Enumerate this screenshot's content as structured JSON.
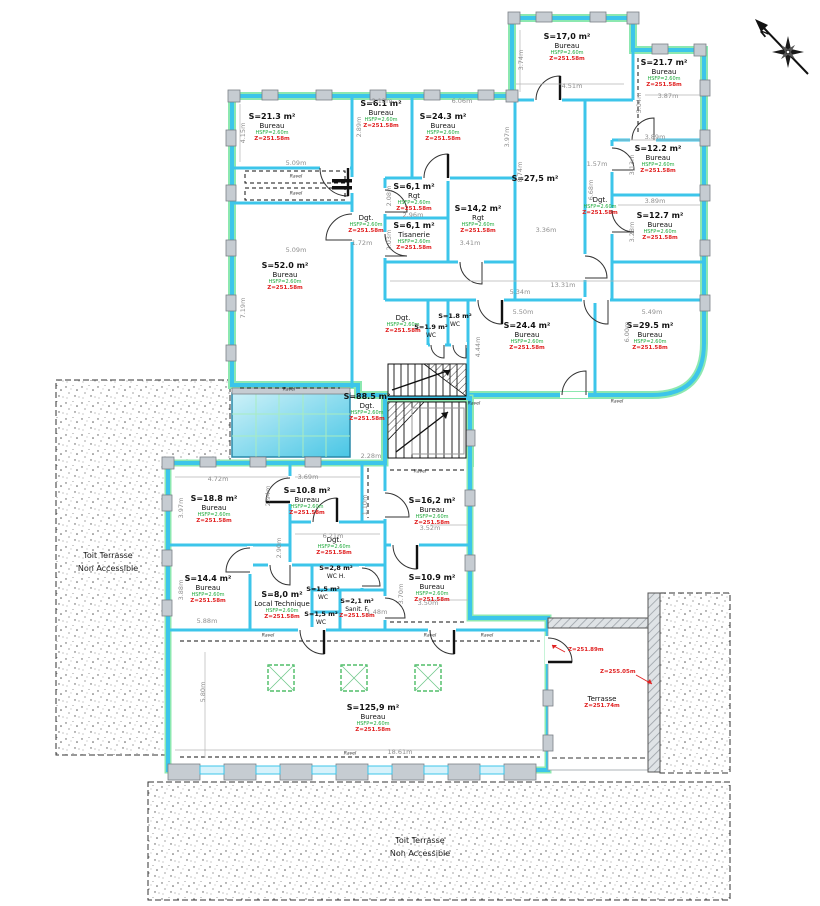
{
  "compass": {
    "label": "N"
  },
  "colors": {
    "wall_cyan": "#3cc5ea",
    "facade_green": "#8ce8b0",
    "label_green": "#1faa3c",
    "label_red": "#e02020",
    "dim_gray": "#8f8f8f",
    "canopy_cyan": "#49c6e5"
  },
  "rooms": [
    {
      "area": "S=21.3 m²",
      "name": "Bureau",
      "hsfp": "HSFP=2.60m",
      "z": "Z=251.58m",
      "x": 272,
      "y": 112
    },
    {
      "area": "S=6.1 m²",
      "name": "Bureau",
      "hsfp": "HSFP=2.60m",
      "z": "Z=251.58m",
      "x": 381,
      "y": 99
    },
    {
      "area": "S=24.3 m²",
      "name": "Bureau",
      "hsfp": "HSFP=2.60m",
      "z": "Z=251.58m",
      "x": 443,
      "y": 112
    },
    {
      "area": "S=17,0 m²",
      "name": "Bureau",
      "hsfp": "HSFP=2.60m",
      "z": "Z=251.58m",
      "x": 567,
      "y": 32
    },
    {
      "area": "S=21.7 m²",
      "name": "Bureau",
      "hsfp": "HSFP=2.60m",
      "z": "Z=251.58m",
      "x": 664,
      "y": 58
    },
    {
      "area": "S=27,5 m²",
      "x": 535,
      "y": 174
    },
    {
      "area": "S=12.2 m²",
      "name": "Bureau",
      "hsfp": "HSFP=2.60m",
      "z": "Z=251.58m",
      "x": 658,
      "y": 144
    },
    {
      "area": "S=12.7 m²",
      "name": "Bureau",
      "hsfp": "HSFP=2.60m",
      "z": "Z=251.58m",
      "x": 660,
      "y": 211
    },
    {
      "area": "S=6,1 m²",
      "name": "Rgt",
      "hsfp": "HSFP=2.60m",
      "z": "Z=251.58m",
      "x": 414,
      "y": 182
    },
    {
      "area": "S=14,2 m²",
      "name": "Rgt",
      "hsfp": "HSFP=2.60m",
      "z": "Z=251.58m",
      "x": 478,
      "y": 204
    },
    {
      "area": "S=6,1 m²",
      "name": "Tisanerie",
      "hsfp": "HSFP=2.60m",
      "z": "Z=251.58m",
      "x": 414,
      "y": 221
    },
    {
      "area": "S=52.0 m²",
      "name": "Bureau",
      "hsfp": "HSFP=2.60m",
      "z": "Z=251.58m",
      "x": 285,
      "y": 261
    },
    {
      "name": "Dgt.",
      "hsfp": "HSFP=2.60m",
      "z": "Z=251.58m",
      "x": 366,
      "y": 214
    },
    {
      "name": "Dgt.",
      "hsfp": "HSFP=2.60m",
      "z": "Z=251.58m",
      "x": 600,
      "y": 196
    },
    {
      "name": "Dgt.",
      "hsfp": "HSFP=2.60m",
      "z": "Z=251.58m",
      "x": 403,
      "y": 314
    },
    {
      "area": "S=1.8 m²",
      "name": "WC",
      "small": true,
      "x": 455,
      "y": 313
    },
    {
      "area": "S=1.9 m²",
      "name": "WC",
      "small": true,
      "x": 431,
      "y": 324
    },
    {
      "area": "S=24.4 m²",
      "name": "Bureau",
      "hsfp": "HSFP=2.60m",
      "z": "Z=251.58m",
      "x": 527,
      "y": 321
    },
    {
      "area": "S=29.5 m²",
      "name": "Bureau",
      "hsfp": "HSFP=2.60m",
      "z": "Z=251.58m",
      "x": 650,
      "y": 321
    },
    {
      "area": "S=88.5 m²",
      "name": "Dgt.",
      "hsfp": "HSFP=2.60m",
      "z": "Z=251.58m",
      "x": 367,
      "y": 392
    },
    {
      "area": "S=18.8 m²",
      "name": "Bureau",
      "hsfp": "HSFP=2.60m",
      "z": "Z=251.58m",
      "x": 214,
      "y": 494
    },
    {
      "area": "S=10.8 m²",
      "name": "Bureau",
      "hsfp": "HSFP=2.60m",
      "z": "Z=251.58m",
      "x": 307,
      "y": 486
    },
    {
      "area": "S=16,2 m²",
      "name": "Bureau",
      "hsfp": "HSFP=2.60m",
      "z": "Z=251.58m",
      "x": 432,
      "y": 496
    },
    {
      "area": "S=14.4 m²",
      "name": "Bureau",
      "hsfp": "HSFP=2.60m",
      "z": "Z=251.58m",
      "x": 208,
      "y": 574
    },
    {
      "area": "S=8,0 m²",
      "name": "Local Technique",
      "hsfp": "HSFP=2.60m",
      "z": "Z=251.58m",
      "x": 282,
      "y": 590
    },
    {
      "area": "S=2,8 m²",
      "name": "WC H.",
      "small": true,
      "x": 336,
      "y": 565
    },
    {
      "area": "S=1,5 m²",
      "name": "WC",
      "small": true,
      "x": 323,
      "y": 586
    },
    {
      "area": "S=2,1 m²",
      "name": "Sanit. F.",
      "z": "Z=251.58m",
      "small": true,
      "x": 357,
      "y": 598
    },
    {
      "area": "S=1,5 m²",
      "name": "WC",
      "small": true,
      "x": 321,
      "y": 611
    },
    {
      "name": "Dgt.",
      "hsfp": "HSFP=2.60m",
      "z": "Z=251.58m",
      "x": 334,
      "y": 536
    },
    {
      "area": "S=10.9 m²",
      "name": "Bureau",
      "hsfp": "HSFP=2.60m",
      "z": "Z=251.58m",
      "x": 432,
      "y": 573
    },
    {
      "area": "S=125,9 m²",
      "name": "Bureau",
      "hsfp": "HSFP=2.60m",
      "z": "Z=251.58m",
      "x": 373,
      "y": 703
    },
    {
      "name": "Terrasse",
      "z": "Z=251.74m",
      "x": 602,
      "y": 695
    }
  ],
  "terrace_labels": [
    {
      "line1": "Toit Terrasse",
      "line2": "Non Accessible",
      "x": 108,
      "y": 550
    },
    {
      "line1": "Toit Terrasse",
      "line2": "Non Accessible",
      "x": 420,
      "y": 835
    }
  ],
  "leaders": [
    {
      "text": "Z=251.89m",
      "x": 568,
      "y": 650
    },
    {
      "text": "Z=255.05m",
      "x": 600,
      "y": 672
    }
  ],
  "marker_label": "Ravel",
  "markers": [
    {
      "x": 268,
      "y": 636
    },
    {
      "x": 430,
      "y": 636
    },
    {
      "x": 487,
      "y": 636
    },
    {
      "x": 350,
      "y": 754
    },
    {
      "x": 296,
      "y": 177
    },
    {
      "x": 296,
      "y": 194
    },
    {
      "x": 420,
      "y": 472
    },
    {
      "x": 289,
      "y": 390
    },
    {
      "x": 474,
      "y": 404
    },
    {
      "x": 617,
      "y": 402
    }
  ],
  "dimensions": [
    {
      "t": "4.15m",
      "x": 243,
      "y": 133,
      "r": -90
    },
    {
      "t": "5.09m",
      "x": 296,
      "y": 163
    },
    {
      "t": "2.12m",
      "x": 382,
      "y": 101
    },
    {
      "t": "2.89m",
      "x": 359,
      "y": 127,
      "r": -90
    },
    {
      "t": "6.06m",
      "x": 462,
      "y": 101
    },
    {
      "t": "3.97m",
      "x": 507,
      "y": 137,
      "r": -90
    },
    {
      "t": "3.74m",
      "x": 521,
      "y": 60,
      "r": -90
    },
    {
      "t": "4.51m",
      "x": 572,
      "y": 86
    },
    {
      "t": "5.04m",
      "x": 639,
      "y": 103,
      "r": -90
    },
    {
      "t": "3.87m",
      "x": 668,
      "y": 96
    },
    {
      "t": "3.89m",
      "x": 655,
      "y": 137
    },
    {
      "t": "3.13m",
      "x": 632,
      "y": 165,
      "r": -90
    },
    {
      "t": "3.89m",
      "x": 655,
      "y": 201
    },
    {
      "t": "3.28m",
      "x": 632,
      "y": 232,
      "r": -90
    },
    {
      "t": "1.57m",
      "x": 597,
      "y": 164
    },
    {
      "t": "8.74m",
      "x": 520,
      "y": 172,
      "r": -90
    },
    {
      "t": "6.68m",
      "x": 591,
      "y": 190,
      "r": -90
    },
    {
      "t": "3.36m",
      "x": 546,
      "y": 230
    },
    {
      "t": "13.31m",
      "x": 563,
      "y": 285
    },
    {
      "t": "2.96m",
      "x": 413,
      "y": 215
    },
    {
      "t": "2.08m",
      "x": 389,
      "y": 196,
      "r": -90
    },
    {
      "t": "2.03m",
      "x": 389,
      "y": 240,
      "r": -90
    },
    {
      "t": "1.72m",
      "x": 362,
      "y": 243
    },
    {
      "t": "3.41m",
      "x": 470,
      "y": 243
    },
    {
      "t": "7.19m",
      "x": 243,
      "y": 308,
      "r": -90
    },
    {
      "t": "5.09m",
      "x": 296,
      "y": 250
    },
    {
      "t": "5.34m",
      "x": 520,
      "y": 292
    },
    {
      "t": "5.50m",
      "x": 523,
      "y": 312
    },
    {
      "t": "5.49m",
      "x": 652,
      "y": 312
    },
    {
      "t": "4.44m",
      "x": 478,
      "y": 347,
      "r": -90
    },
    {
      "t": "6.00m",
      "x": 627,
      "y": 332,
      "r": -90
    },
    {
      "t": "2.28m",
      "x": 371,
      "y": 456
    },
    {
      "t": "4.72m",
      "x": 218,
      "y": 479
    },
    {
      "t": "3.69m",
      "x": 308,
      "y": 477
    },
    {
      "t": "2.94m",
      "x": 268,
      "y": 496,
      "r": -90
    },
    {
      "t": "3.97m",
      "x": 181,
      "y": 508,
      "r": -90
    },
    {
      "t": "1.10m",
      "x": 365,
      "y": 505,
      "r": -90
    },
    {
      "t": "6.21m",
      "x": 333,
      "y": 536
    },
    {
      "t": "2.90m",
      "x": 279,
      "y": 548,
      "r": -90
    },
    {
      "t": "3.88m",
      "x": 181,
      "y": 590,
      "r": -90
    },
    {
      "t": "5.88m",
      "x": 207,
      "y": 621
    },
    {
      "t": "1.48m",
      "x": 377,
      "y": 612
    },
    {
      "t": "3.52m",
      "x": 430,
      "y": 528
    },
    {
      "t": "3.50m",
      "x": 428,
      "y": 603
    },
    {
      "t": "3.70m",
      "x": 401,
      "y": 594,
      "r": -90
    },
    {
      "t": "18.61m",
      "x": 400,
      "y": 752
    },
    {
      "t": "5.80m",
      "x": 203,
      "y": 692,
      "r": -90
    }
  ]
}
